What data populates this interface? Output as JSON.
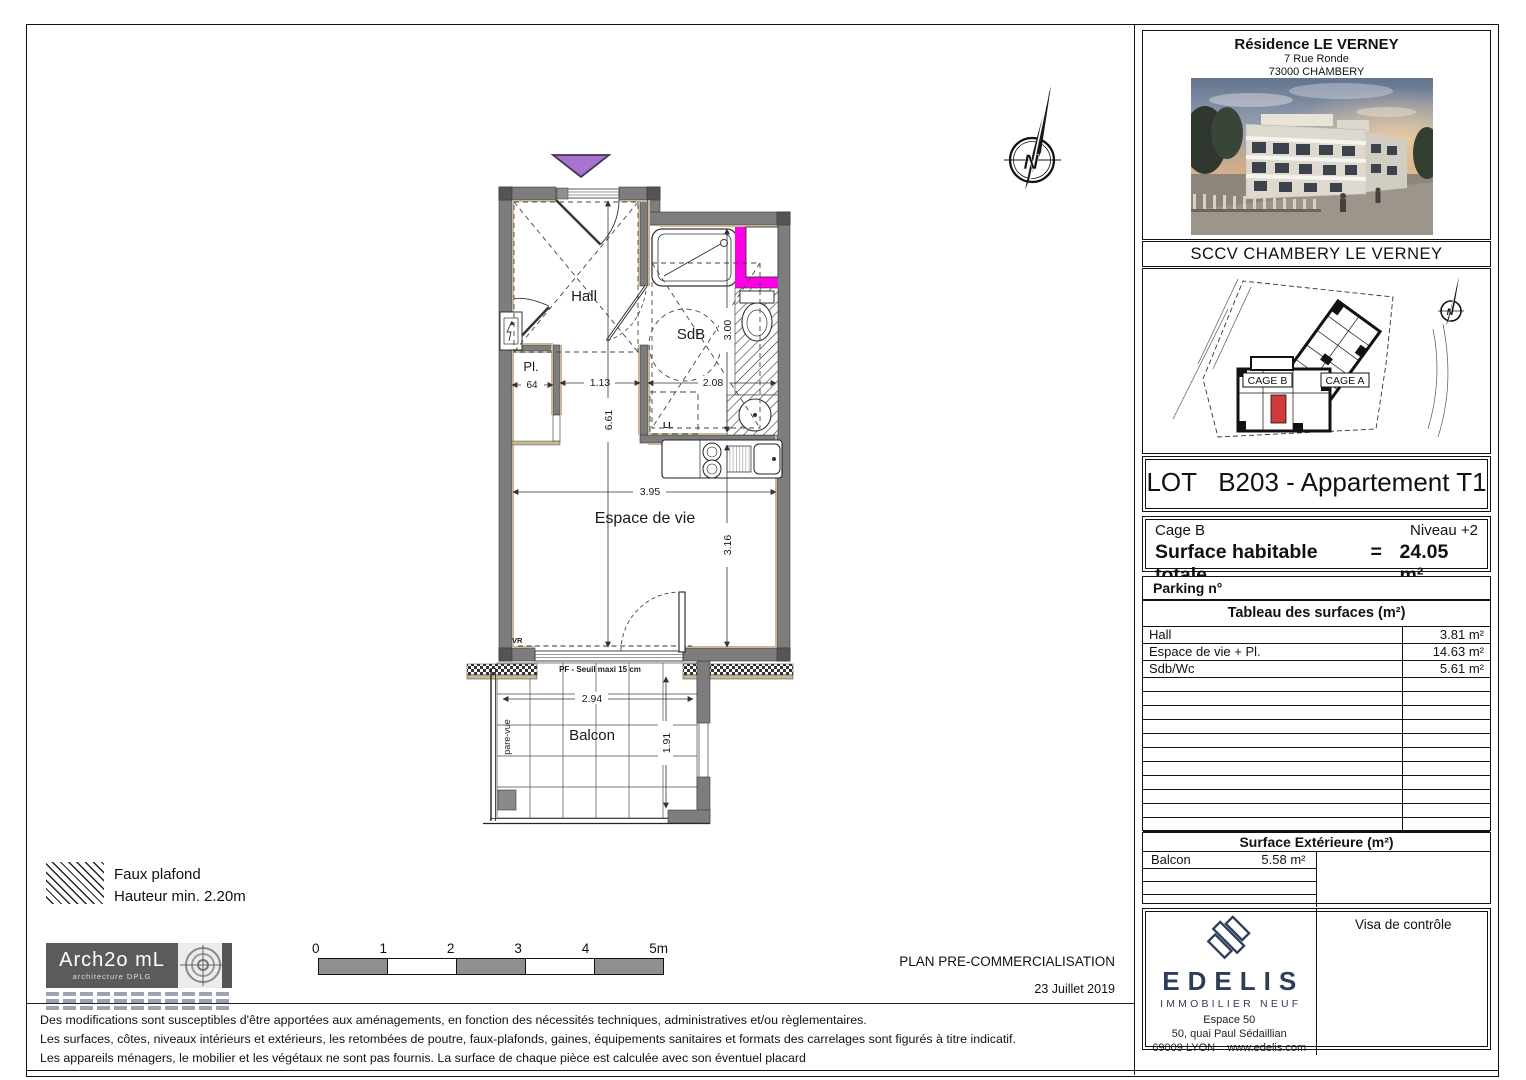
{
  "plan": {
    "rooms": {
      "hall": "Hall",
      "placard": "Pl.",
      "bathroom": "SdB",
      "living": "Espace de vie",
      "balcony": "Balcon"
    },
    "annotations": {
      "washing_machine": "LL",
      "shutter": "VR",
      "door_sill": "PF - Seuil maxi 15 cm",
      "privacy_screen": "pare-vue"
    },
    "dimensions": {
      "closet_width": "64",
      "hall_width": "1.13",
      "bathroom_width": "2.08",
      "bathroom_depth": "3.00",
      "apartment_depth": "6.61",
      "living_width": "3.95",
      "living_depth": "3.16",
      "balcony_width": "2.94",
      "balcony_depth": "1.91"
    },
    "compass_letter": "N",
    "colors": {
      "wall": "#7d7d7d",
      "wood_trim": "#c9b896",
      "gaine_highlight": "#ff00e6",
      "entrance_marker": "#a873cf"
    }
  },
  "title_block": {
    "residence": "Résidence LE VERNEY",
    "address_line1": "7 Rue Ronde",
    "address_line2": "73000 CHAMBERY",
    "company": "SCCV CHAMBERY LE VERNEY",
    "site_plan": {
      "cage_b": "CAGE B",
      "cage_a": "CAGE A",
      "compass_letter": "N",
      "unit_highlight_color": "#cf3a3a"
    },
    "lot_title": "LOT   B203 - Appartement T1",
    "cage": "Cage B",
    "level": "Niveau +2",
    "surface_label": "Surface habitable totale",
    "surface_equals": "=",
    "surface_total": "24.05 m²",
    "parking_label": "Parking n°",
    "surfaces_table": {
      "header": "Tableau des surfaces (m²)",
      "rows": [
        {
          "label": "Hall",
          "value": "3.81 m²"
        },
        {
          "label": "Espace de vie + Pl.",
          "value": "14.63 m²"
        },
        {
          "label": "Sdb/Wc",
          "value": "5.61 m²"
        }
      ]
    },
    "exterior_table": {
      "header": "Surface Extérieure (m²)",
      "rows": [
        {
          "label": "Balcon",
          "value": "5.58 m²"
        }
      ]
    },
    "visa_label": "Visa de contrôle",
    "edelis": {
      "name": "EDELIS",
      "tagline": "IMMOBILIER NEUF",
      "line1": "Espace 50",
      "line2": "50, quai Paul Sédaillian",
      "city": "69009 LYON",
      "website": "www.edelis.com",
      "brand_color": "#2e3d59"
    }
  },
  "legend": {
    "line1": "Faux plafond",
    "line2": "Hauteur min. 2.20m"
  },
  "architect": {
    "name": "Arch2o mL",
    "subtitle": "architecture DPLG"
  },
  "scale_bar": {
    "labels": [
      "0",
      "1",
      "2",
      "3",
      "4",
      "5m"
    ]
  },
  "footer": {
    "plan_type": "PLAN PRE-COMMERCIALISATION",
    "date": "23 Juillet 2019",
    "notes": [
      "Des modifications sont susceptibles d'être apportées aux aménagements, en fonction des nécessités techniques, administratives et/ou règlementaires.",
      "Les surfaces, côtes, niveaux intérieurs et extérieurs, les retombées de poutre, faux-plafonds, gaines, équipements sanitaires et formats des carrelages sont figurés à titre indicatif.",
      "Les appareils ménagers, le mobilier et les végétaux ne sont pas fournis. La surface de chaque pièce est calculée avec son éventuel placard"
    ]
  }
}
